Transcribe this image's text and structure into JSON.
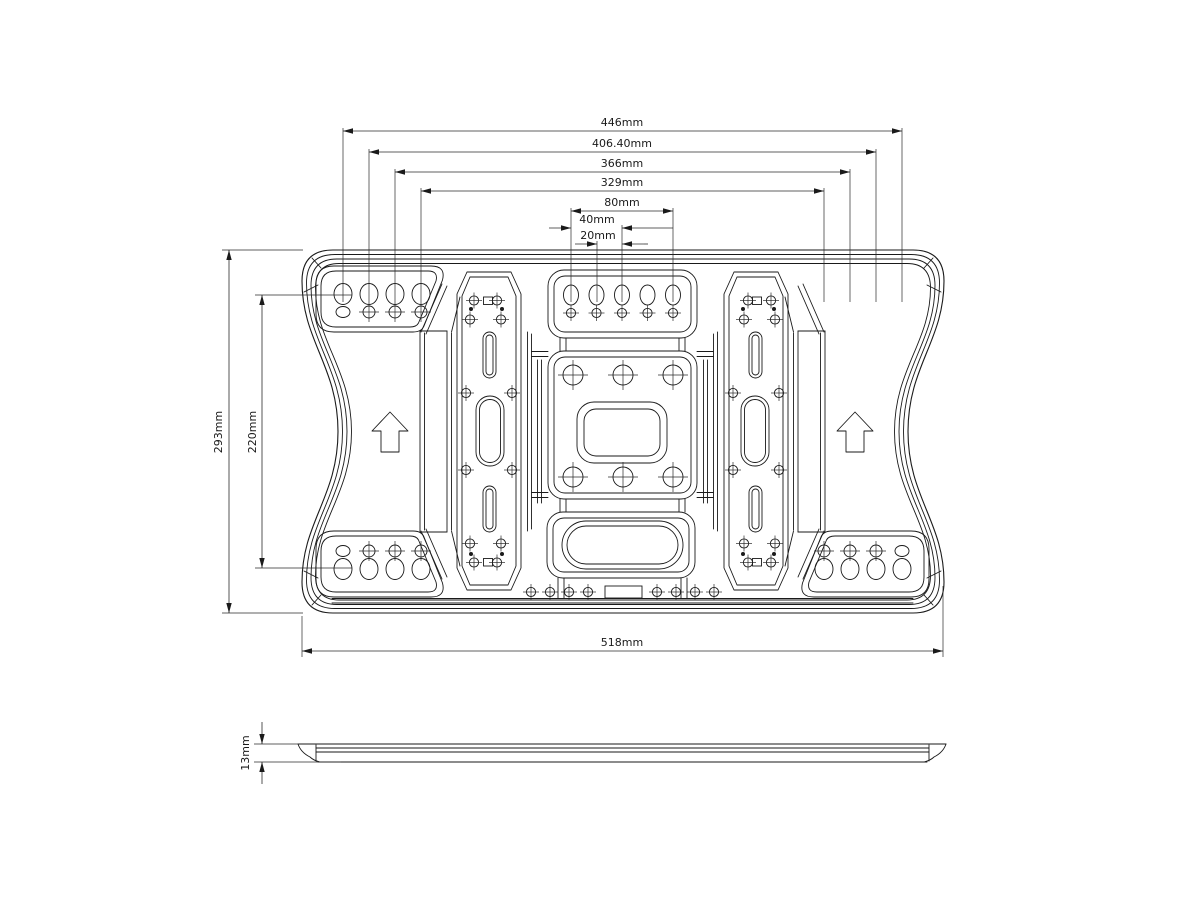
{
  "drawing": {
    "kind": "tv-wall-mount-plate-engineering-drawing",
    "views": {
      "front": "plate-front-view",
      "side": "plate-side-profile-view"
    },
    "orientation_arrow_icon": "up-arrow"
  },
  "dimensions": {
    "top": [
      "446mm",
      "406.40mm",
      "366mm",
      "329mm",
      "80mm",
      "40mm",
      "20mm"
    ],
    "left": [
      "293mm",
      "220mm"
    ],
    "bottom": [
      "518mm"
    ],
    "side": [
      "13mm"
    ]
  },
  "colors": {
    "line": "#1a1a1a",
    "dimension_line": "#2a2a2a",
    "background": "#ffffff"
  }
}
